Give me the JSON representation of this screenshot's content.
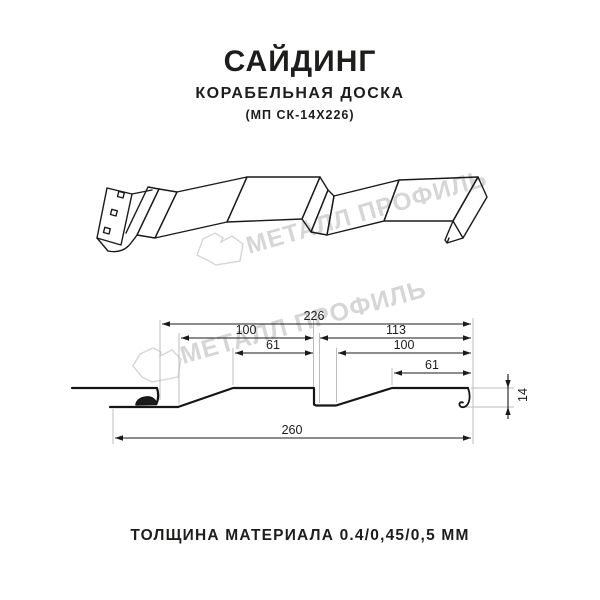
{
  "header": {
    "title": "САЙДИНГ",
    "subtitle": "КОРАБЕЛЬНАЯ ДОСКА",
    "model": "(МП СК-14Х226)"
  },
  "watermark": {
    "text": "МЕТАЛЛ ПРОФИЛЬ",
    "color": "#d6d6d6"
  },
  "drawing": {
    "type": "siding profile cross-section, dimensions in mm",
    "dimensions": {
      "module_width": "226",
      "left_panel_width": "100",
      "left_top_flat": "61",
      "right_span": "113",
      "right_panel_width": "100",
      "right_top_flat": "61",
      "overall_width": "260",
      "profile_height": "14"
    }
  },
  "footer": {
    "thickness_label": "ТОЛЩИНА МАТЕРИАЛА 0.4/0,45/0,5 ММ"
  },
  "colors": {
    "line": "#1a1a1a",
    "extension_line": "#bdbdbd",
    "text": "#1d1d1b",
    "watermark": "#d6d6d6",
    "background": "#ffffff"
  }
}
